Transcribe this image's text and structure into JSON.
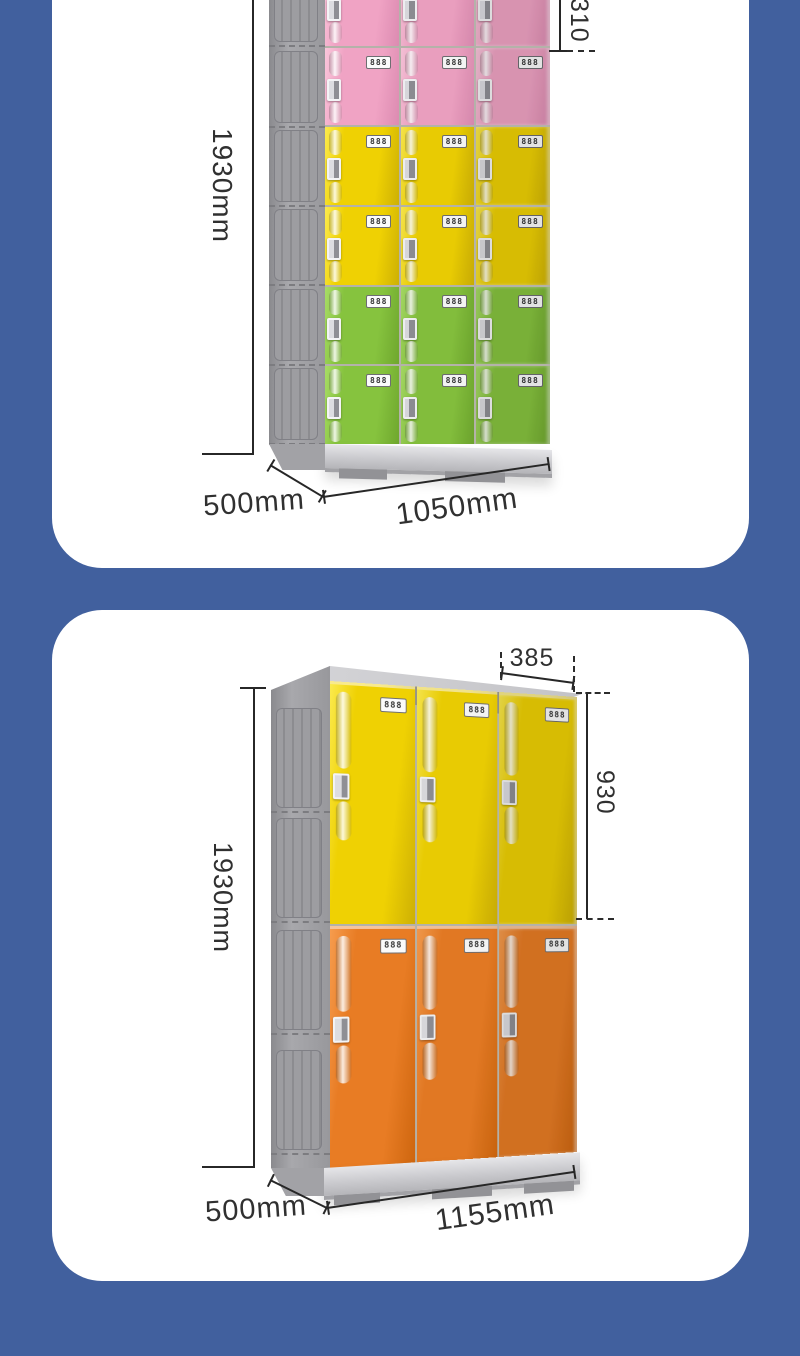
{
  "page": {
    "background_color": "#41609E",
    "card_color": "#FFFFFF"
  },
  "cards": [
    {
      "id": "six-tier-locker",
      "dimensions": {
        "height": "1930mm",
        "depth": "500mm",
        "width": "1050mm",
        "door_pitch": "310"
      },
      "locker": {
        "columns": 3,
        "rows_per_section": 2,
        "lock_display": "888",
        "sections": [
          {
            "name": "pink",
            "base": "#F0A3C4",
            "dark": "#DC8BB1",
            "light": "#FAC6DB"
          },
          {
            "name": "yellow",
            "base": "#EFD103",
            "dark": "#CDB004",
            "light": "#FBEA4E"
          },
          {
            "name": "green",
            "base": "#86C33E",
            "dark": "#6FA72E",
            "light": "#A8DC66"
          }
        ]
      }
    },
    {
      "id": "two-tier-locker",
      "dimensions": {
        "height": "1930mm",
        "depth": "500mm",
        "width": "1155mm",
        "door_width": "385",
        "door_height": "930"
      },
      "locker": {
        "columns": 3,
        "rows_per_section": 1,
        "lock_display": "888",
        "sections": [
          {
            "name": "yellow",
            "base": "#EFD103",
            "dark": "#CDB004",
            "light": "#FBEA4E"
          },
          {
            "name": "orange",
            "base": "#E87C24",
            "dark": "#CE660F",
            "light": "#F69C4E"
          }
        ]
      }
    }
  ]
}
